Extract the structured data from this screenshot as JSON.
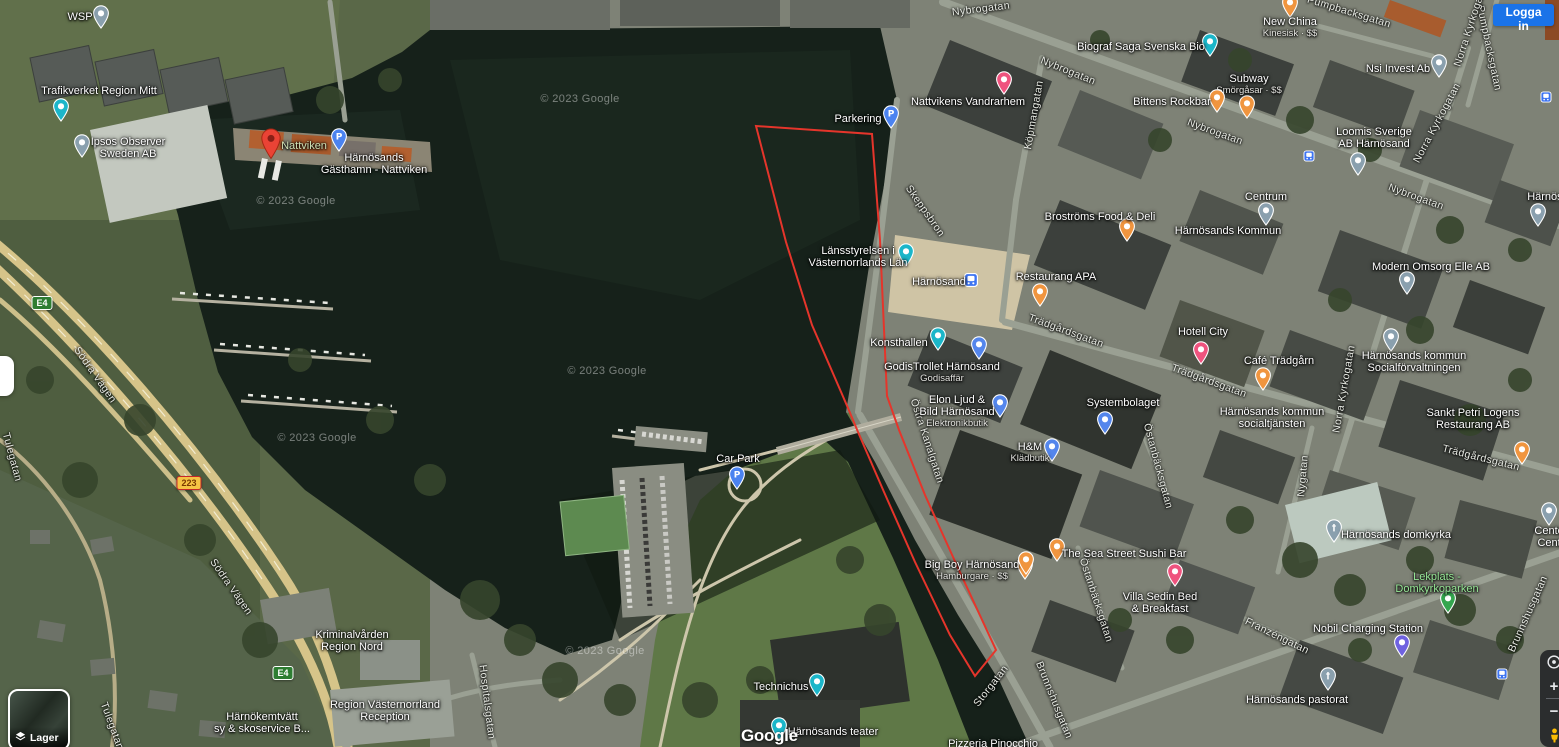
{
  "header": {
    "signin_label": "Logga in"
  },
  "controls": {
    "layers_label": "Lager",
    "zoom_in_label": "+",
    "zoom_out_label": "−"
  },
  "attribution": {
    "logo_text": "Google",
    "copyright_text": "© 2023 Google"
  },
  "overlay": {
    "red_polygon": {
      "color": "#E5352B",
      "stroke_width": 2,
      "points": "756,126 872,134 880,240 887,396 899,430 925,495 958,568 996,650 975,676 950,635 915,562 884,492 858,432 848,408 812,325 786,242"
    }
  },
  "map": {
    "street_labels": [
      {
        "t": "Nybrogatan",
        "x": 981,
        "y": 9,
        "r": -7
      },
      {
        "t": "Nybrogatan",
        "x": 1068,
        "y": 71,
        "r": 22
      },
      {
        "t": "Nybrogatan",
        "x": 1215,
        "y": 132,
        "r": 20
      },
      {
        "t": "Nybrogatan",
        "x": 1416,
        "y": 197,
        "r": 20
      },
      {
        "t": "Pumpbacksgatan",
        "x": 1349,
        "y": 12,
        "r": 17
      },
      {
        "t": "Pumpbacksgatan",
        "x": 1489,
        "y": 48,
        "r": 78
      },
      {
        "t": "Norra Kyrkogatan",
        "x": 1471,
        "y": 24,
        "r": -72
      },
      {
        "t": "Norra Kyrkogatan",
        "x": 1437,
        "y": 123,
        "r": -62
      },
      {
        "t": "Norra Kyrkogatan",
        "x": 1344,
        "y": 389,
        "r": -80
      },
      {
        "t": "Köpmangatan",
        "x": 1034,
        "y": 115,
        "r": -80
      },
      {
        "t": "Skeppsbron",
        "x": 925,
        "y": 211,
        "r": 55
      },
      {
        "t": "Storgatan",
        "x": 991,
        "y": 686,
        "r": -52
      },
      {
        "t": "Brunnshusgatan",
        "x": 1054,
        "y": 700,
        "r": 68
      },
      {
        "t": "Brunnshusgatan",
        "x": 1528,
        "y": 614,
        "r": -66
      },
      {
        "t": "Trädgårdsgatan",
        "x": 1066,
        "y": 331,
        "r": 20
      },
      {
        "t": "Trädgårdsgatan",
        "x": 1209,
        "y": 381,
        "r": 20
      },
      {
        "t": "Trädgårdsgatan",
        "x": 1481,
        "y": 458,
        "r": 14
      },
      {
        "t": "Nygatan",
        "x": 1303,
        "y": 476,
        "r": -85
      },
      {
        "t": "Östra Kanalgatan",
        "x": 927,
        "y": 441,
        "r": 72
      },
      {
        "t": "Östanbäcksgatan",
        "x": 1096,
        "y": 600,
        "r": 72
      },
      {
        "t": "Östanbäcksgatan",
        "x": 1158,
        "y": 466,
        "r": 75
      },
      {
        "t": "Franzéngatan",
        "x": 1277,
        "y": 636,
        "r": 26
      },
      {
        "t": "Hospitalsgatan",
        "x": 487,
        "y": 702,
        "r": 83
      },
      {
        "t": "Södra Vägen",
        "x": 95,
        "y": 375,
        "r": 55
      },
      {
        "t": "Södra Vägen",
        "x": 231,
        "y": 587,
        "r": 55
      },
      {
        "t": "Tulegatan",
        "x": 12,
        "y": 457,
        "r": 75
      },
      {
        "t": "Tulegatan",
        "x": 112,
        "y": 726,
        "r": 70
      }
    ],
    "watermarks": [
      {
        "x": 580,
        "y": 99
      },
      {
        "x": 296,
        "y": 201
      },
      {
        "x": 607,
        "y": 371
      },
      {
        "x": 317,
        "y": 438
      },
      {
        "x": 605,
        "y": 651
      }
    ],
    "road_shields": [
      {
        "label": "E4",
        "bg": "#2E7D32",
        "border": "#FFFFFF",
        "text": "#FFFFFF",
        "x": 42,
        "y": 303
      },
      {
        "label": "E4",
        "bg": "#2E7D32",
        "border": "#FFFFFF",
        "text": "#FFFFFF",
        "x": 283,
        "y": 673
      },
      {
        "label": "223",
        "bg": "#F6C344",
        "border": "#C62828",
        "text": "#7A3A00",
        "x": 189,
        "y": 483
      }
    ],
    "transit_icons": [
      {
        "x": 1309,
        "y": 156
      },
      {
        "x": 1502,
        "y": 674
      },
      {
        "x": 1546,
        "y": 97
      }
    ],
    "pois": [
      {
        "n": [
          "WSP"
        ],
        "x": 80,
        "y": 11,
        "m": [
          {
            "k": "pin",
            "c": "#8AA0AE",
            "x": 101,
            "y": 5
          }
        ]
      },
      {
        "n": [
          "Trafikverket Region Mitt"
        ],
        "x": 99,
        "y": 85,
        "m": [
          {
            "k": "pin",
            "c": "#1BB6C9",
            "x": 61,
            "y": 98
          }
        ]
      },
      {
        "n": [
          "Ipsos Observer",
          "Sweden AB"
        ],
        "x": 128,
        "y": 136,
        "m": [
          {
            "k": "pin",
            "c": "#8AA0AE",
            "x": 82,
            "y": 134
          }
        ]
      },
      {
        "n": [
          "Nattviken"
        ],
        "c": "#cfe0b5",
        "x": 304,
        "y": 140,
        "m": [
          {
            "k": "redpin",
            "x": 271,
            "y": 128
          }
        ]
      },
      {
        "n": [
          "Härnösands",
          "Gästhamn - Nattviken"
        ],
        "x": 374,
        "y": 152,
        "m": [
          {
            "k": "pin",
            "c": "#4B83F0",
            "g": "P",
            "x": 339,
            "y": 128
          }
        ]
      },
      {
        "n": [
          "Parkering"
        ],
        "x": 858,
        "y": 113,
        "m": [
          {
            "k": "pin",
            "c": "#4B83F0",
            "g": "P",
            "x": 891,
            "y": 105
          }
        ]
      },
      {
        "n": [
          "Nattvikens Vandrarhem"
        ],
        "x": 968,
        "y": 96,
        "m": [
          {
            "k": "pin",
            "c": "#EF537E",
            "x": 1004,
            "y": 71
          }
        ]
      },
      {
        "n": [
          "Biograf Saga Svenska Bio"
        ],
        "x": 1141,
        "y": 41,
        "m": [
          {
            "k": "pin",
            "c": "#1BB6C9",
            "x": 1210,
            "y": 33
          }
        ]
      },
      {
        "n": [
          "New China"
        ],
        "s": "Kinesisk · $$",
        "x": 1290,
        "y": 16,
        "m": [
          {
            "k": "pin",
            "c": "#F0953F",
            "x": 1290,
            "y": -6
          }
        ]
      },
      {
        "n": [
          "Subway"
        ],
        "s": "Smörgåsar · $$",
        "x": 1249,
        "y": 73,
        "m": [
          {
            "k": "pin",
            "c": "#F0953F",
            "x": 1247,
            "y": 95
          }
        ]
      },
      {
        "n": [
          "Bittens Rockbar"
        ],
        "x": 1172,
        "y": 96,
        "m": [
          {
            "k": "pin",
            "c": "#F0953F",
            "x": 1217,
            "y": 89
          }
        ]
      },
      {
        "n": [
          "Nsi Invest Ab"
        ],
        "x": 1398,
        "y": 63,
        "m": [
          {
            "k": "pin",
            "c": "#8AA0AE",
            "x": 1439,
            "y": 54
          }
        ]
      },
      {
        "n": [
          "Loomis Sverige",
          "AB Härnösand"
        ],
        "x": 1374,
        "y": 126,
        "m": [
          {
            "k": "pin",
            "c": "#8AA0AE",
            "x": 1358,
            "y": 152
          }
        ]
      },
      {
        "n": [
          "Broströms Food & Deli"
        ],
        "x": 1100,
        "y": 211,
        "m": [
          {
            "k": "pin",
            "c": "#F0953F",
            "x": 1127,
            "y": 218
          }
        ]
      },
      {
        "n": [
          "Centrum"
        ],
        "x": 1266,
        "y": 191,
        "m": [
          {
            "k": "pin",
            "c": "#8AA0AE",
            "x": 1266,
            "y": 202
          }
        ]
      },
      {
        "n": [
          "Härnösands Kommun"
        ],
        "x": 1228,
        "y": 225,
        "m": []
      },
      {
        "n": [
          "Modern Omsorg Elle AB"
        ],
        "x": 1431,
        "y": 261,
        "m": [
          {
            "k": "pin",
            "c": "#8AA0AE",
            "x": 1407,
            "y": 271
          }
        ]
      },
      {
        "n": [
          "Länsstyrelsen i",
          "Västernorrlands Län"
        ],
        "x": 858,
        "y": 245,
        "m": [
          {
            "k": "pin",
            "c": "#1BB6C9",
            "x": 906,
            "y": 243
          }
        ]
      },
      {
        "n": [
          "Härnösand"
        ],
        "x": 939,
        "y": 276,
        "m": [
          {
            "k": "transit",
            "sz": 14,
            "x": 971,
            "y": 273
          }
        ]
      },
      {
        "n": [
          "Restaurang APA"
        ],
        "x": 1056,
        "y": 271,
        "m": [
          {
            "k": "pin",
            "c": "#F0953F",
            "x": 1040,
            "y": 283
          }
        ]
      },
      {
        "n": [
          "Hotell City"
        ],
        "x": 1203,
        "y": 326,
        "m": [
          {
            "k": "pin",
            "c": "#EF537E",
            "x": 1201,
            "y": 341
          }
        ]
      },
      {
        "n": [
          "Café Trädgårn"
        ],
        "x": 1279,
        "y": 355,
        "m": [
          {
            "k": "pin",
            "c": "#F0953F",
            "x": 1263,
            "y": 367
          }
        ]
      },
      {
        "n": [
          "Härnösands kommun",
          "Socialförvaltningen"
        ],
        "x": 1414,
        "y": 350,
        "m": [
          {
            "k": "pin",
            "c": "#8AA0AE",
            "x": 1391,
            "y": 328
          }
        ]
      },
      {
        "n": [
          "Konsthallen"
        ],
        "x": 899,
        "y": 337,
        "m": [
          {
            "k": "pin",
            "c": "#1BB6C9",
            "x": 938,
            "y": 327
          }
        ]
      },
      {
        "n": [
          "GodisTrollet Härnösand"
        ],
        "s": "Godisaffär",
        "x": 942,
        "y": 361,
        "m": [
          {
            "k": "pin",
            "c": "#5486EC",
            "x": 979,
            "y": 336
          }
        ]
      },
      {
        "n": [
          "Elon Ljud &",
          "Bild Härnösand"
        ],
        "s": "Elektronikbutik",
        "x": 957,
        "y": 394,
        "m": [
          {
            "k": "pin",
            "c": "#5486EC",
            "x": 1000,
            "y": 394
          }
        ]
      },
      {
        "n": [
          "Systembolaget"
        ],
        "x": 1123,
        "y": 397,
        "m": [
          {
            "k": "pin",
            "c": "#5486EC",
            "x": 1105,
            "y": 411
          }
        ]
      },
      {
        "n": [
          "Härnösands kommun",
          "socialtjänsten"
        ],
        "x": 1272,
        "y": 406,
        "m": []
      },
      {
        "n": [
          "Sankt Petri Logens",
          "Restaurang AB"
        ],
        "x": 1473,
        "y": 407,
        "m": [
          {
            "k": "pin",
            "c": "#F0953F",
            "x": 1522,
            "y": 441
          }
        ]
      },
      {
        "n": [
          "H&M"
        ],
        "s": "Klädbutik",
        "x": 1030,
        "y": 441,
        "m": [
          {
            "k": "pin",
            "c": "#5486EC",
            "x": 1052,
            "y": 438
          }
        ]
      },
      {
        "n": [
          "Car Park"
        ],
        "x": 738,
        "y": 453,
        "m": [
          {
            "k": "pin",
            "c": "#4B83F0",
            "g": "P",
            "x": 737,
            "y": 466
          }
        ]
      },
      {
        "n": [
          "Big Boy Härnösand"
        ],
        "s": "Hamburgare · $$",
        "x": 972,
        "y": 559,
        "m": [
          {
            "k": "pin",
            "c": "#F0953F",
            "x": 1025,
            "y": 556
          }
        ]
      },
      {
        "n": [
          "The Sea Street Sushi Bar"
        ],
        "x": 1124,
        "y": 548,
        "m": [
          {
            "k": "pin",
            "c": "#F0953F",
            "x": 1057,
            "y": 538
          },
          {
            "k": "pin",
            "c": "#F0953F",
            "x": 1026,
            "y": 551
          }
        ]
      },
      {
        "n": [
          "Villa Sedin Bed",
          "& Breakfast"
        ],
        "x": 1160,
        "y": 591,
        "m": [
          {
            "k": "pin",
            "c": "#EF537E",
            "x": 1175,
            "y": 563
          }
        ]
      },
      {
        "n": [
          "Härnösands domkyrka"
        ],
        "x": 1396,
        "y": 529,
        "m": [
          {
            "k": "pin",
            "c": "#8AA0AE",
            "g": "†",
            "x": 1334,
            "y": 519
          }
        ]
      },
      {
        "n": [
          "Lekplats -",
          "Domkyrkoparken"
        ],
        "c": "#97e897",
        "x": 1437,
        "y": 571,
        "m": [
          {
            "k": "pin",
            "c": "#34A64E",
            "x": 1448,
            "y": 590
          }
        ]
      },
      {
        "n": [
          "Nobil Charging Station"
        ],
        "x": 1368,
        "y": 623,
        "m": [
          {
            "k": "pin",
            "c": "#6F62E0",
            "x": 1402,
            "y": 634
          }
        ]
      },
      {
        "n": [
          "Härnösands pastorat"
        ],
        "x": 1297,
        "y": 694,
        "m": [
          {
            "k": "pin",
            "c": "#8AA0AE",
            "g": "†",
            "x": 1328,
            "y": 667
          }
        ]
      },
      {
        "n": [
          "Centerp",
          "Center"
        ],
        "x": 1554,
        "y": 525,
        "m": [
          {
            "k": "pin",
            "c": "#8AA0AE",
            "x": 1549,
            "y": 502
          }
        ]
      },
      {
        "n": [
          "Technichus"
        ],
        "x": 781,
        "y": 681,
        "m": [
          {
            "k": "pin",
            "c": "#1BB6C9",
            "x": 817,
            "y": 673
          }
        ]
      },
      {
        "n": [
          "Härnösands teater"
        ],
        "x": 833,
        "y": 726,
        "m": [
          {
            "k": "pin",
            "c": "#1BB6C9",
            "x": 779,
            "y": 717
          }
        ]
      },
      {
        "n": [
          "Region Västernorrland",
          "Reception"
        ],
        "x": 385,
        "y": 699,
        "m": []
      },
      {
        "n": [
          "Härnökemtvätt",
          "sy & skoservice B..."
        ],
        "x": 262,
        "y": 711,
        "m": []
      },
      {
        "n": [
          "Kriminalvården",
          "Region Nord"
        ],
        "x": 352,
        "y": 629,
        "m": []
      },
      {
        "n": [
          "Pizzeria Pinocchio"
        ],
        "x": 993,
        "y": 738,
        "m": []
      },
      {
        "n": [
          "Härnösa"
        ],
        "x": 1548,
        "y": 191,
        "m": [
          {
            "k": "pin",
            "c": "#8AA0AE",
            "x": 1538,
            "y": 203
          }
        ]
      }
    ]
  }
}
